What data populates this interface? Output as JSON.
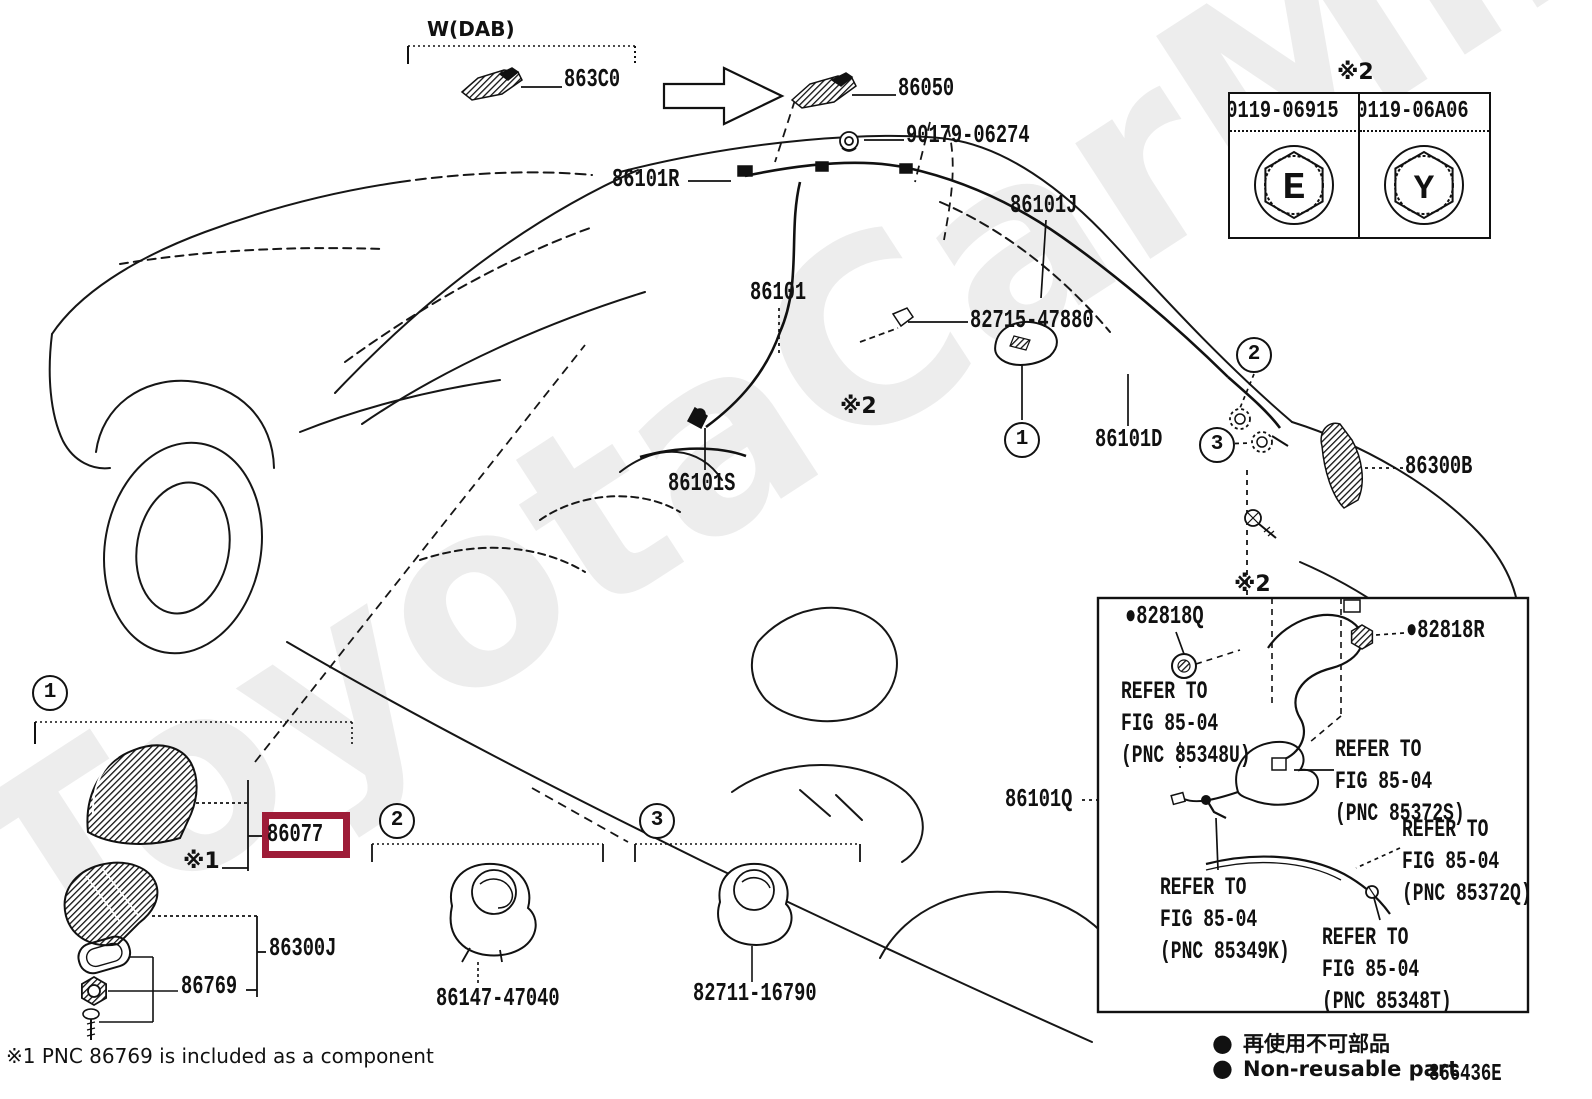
{
  "watermark": "ToyotaCarMine.ru",
  "colors": {
    "highlight_box": "#9e1c38",
    "ink": "#111111",
    "watermark": "#ededed"
  },
  "top_group": {
    "wdab": "W(DAB)",
    "p863c0": "863C0",
    "p86050": "86050",
    "p90179": "90179-06274"
  },
  "nut_table": {
    "note": "※2",
    "left_part": "90119-06915",
    "right_part": "90119-06A06",
    "left_glyph": "E",
    "right_glyph": "Y"
  },
  "car_labels": {
    "p86101r": "86101R",
    "p86101j": "86101J",
    "p86101": "86101",
    "p82715": "82715-47880",
    "p86101s": "86101S",
    "p86101d": "86101D",
    "p86300b": "86300B",
    "p86101q": "86101Q"
  },
  "notes": {
    "n1": "※1",
    "n2": "※2"
  },
  "callouts": {
    "c1": "1",
    "c2": "2",
    "c3": "3"
  },
  "inset_box": {
    "p82818q": "●82818Q",
    "p82818r": "●82818R",
    "refs": [
      {
        "l1": "REFER TO",
        "l2": "FIG 85-04",
        "l3": "(PNC 85348U)"
      },
      {
        "l1": "REFER TO",
        "l2": "FIG 85-04",
        "l3": "(PNC 85372S)"
      },
      {
        "l1": "REFER TO",
        "l2": "FIG 85-04",
        "l3": "(PNC 85372Q)"
      },
      {
        "l1": "REFER TO",
        "l2": "FIG 85-04",
        "l3": "(PNC 85349K)"
      },
      {
        "l1": "REFER TO",
        "l2": "FIG 85-04",
        "l3": "(PNC 85348T)"
      }
    ]
  },
  "antenna_group": {
    "p86077": "86077",
    "p86300j": "86300J",
    "p86769": "86769"
  },
  "clip_group": {
    "p86147": "86147-47040",
    "p82711": "82711-16790"
  },
  "legend": {
    "bullet": "●",
    "jp": "再使用不可部品",
    "en": "Non-reusable part",
    "code": "866436E"
  },
  "footnote": "※1 PNC 86769 is included as a component"
}
